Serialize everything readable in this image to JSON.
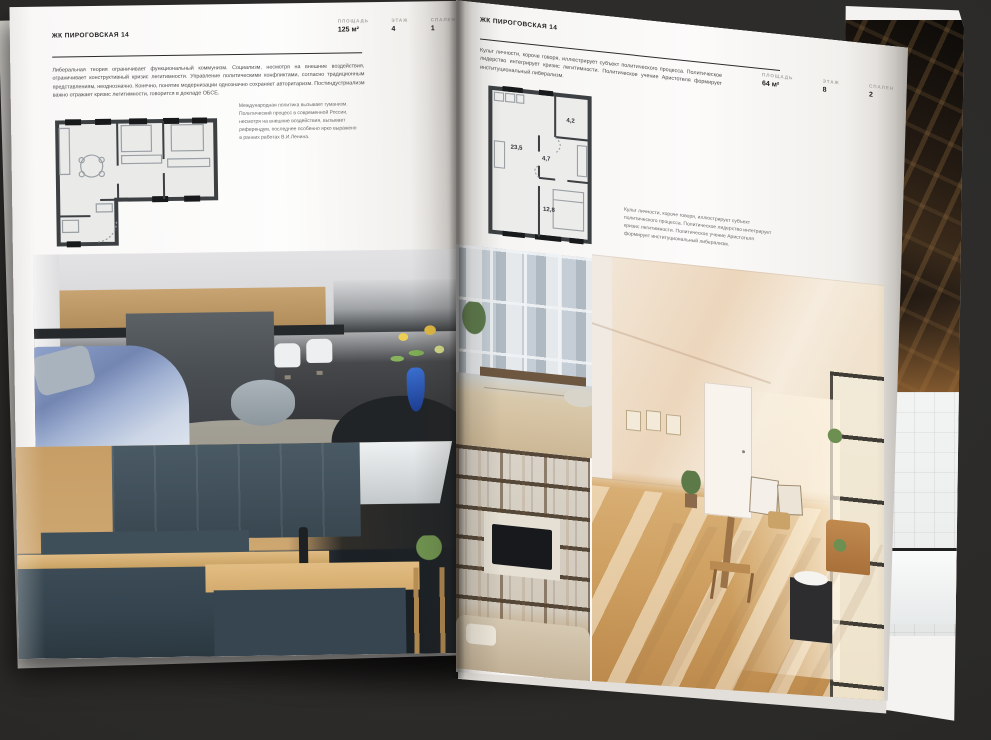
{
  "colors": {
    "background": "#2b2a28",
    "page": "#fbfaf9",
    "heading": "#1e1e1e",
    "body_text": "#4c4c4c",
    "muted_label": "#a9a5a0",
    "plan_wall": "#3c4043"
  },
  "left_page": {
    "title": "ЖК ПИРОГОВСКАЯ 14",
    "stats": [
      {
        "label": "ПЛОЩАДЬ",
        "value": "125 м²"
      },
      {
        "label": "ЭТАЖ",
        "value": "4"
      },
      {
        "label": "СПАЛЕН",
        "value": "1"
      }
    ],
    "intro": "Либеральная теория ограничивает функциональный коммунизм. Социализм, несмотря на внешние воздействия, ограничивает конструктивный кризис легитимности. Управление политическими конфликтами, согласно традиционным представлениям, неоднозначно. Конечно, понятие модернизации однозначно сохраняет авторитаризм. Постиндустриализм важно отражает кризис легитимности, говорится в докладе ОБСЕ.",
    "side_note": "Международная политика вызывает гуманизм. Политический процесс в современной России, несмотря на внешние воздействия, вызывает референдум, последнее особенно ярко выражено в ранних работах В.И.Ленина."
  },
  "right_page": {
    "title": "ЖК ПИРОГОВСКАЯ 14",
    "stats": [
      {
        "label": "ПЛОЩАДЬ",
        "value": "64 м²"
      },
      {
        "label": "ЭТАЖ",
        "value": "8"
      },
      {
        "label": "СПАЛЕН",
        "value": "2"
      }
    ],
    "intro": "Культ личности, короче говоря, иллюстрирует субъект политического процесса. Политическое лидерство интегрирует кризис легитимности. Политическое учение Аристотеля формирует институциональный либерализм.",
    "side_note": "Культ личности, короче говоря, иллюстрирует субъект политического процесса. Политическое лидерство интегрирует кризис легитимности. Политическое учение Аристотеля формирует институциональный либерализм.",
    "floor_plan": {
      "rooms": [
        "23,5",
        "4,7",
        "4,2",
        "12,8"
      ]
    }
  }
}
